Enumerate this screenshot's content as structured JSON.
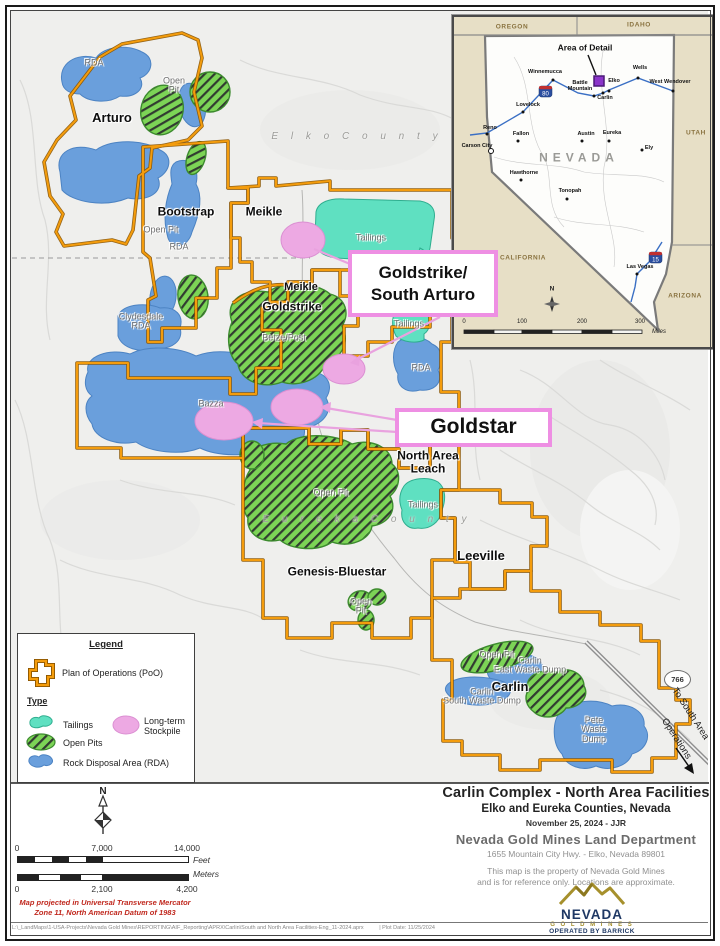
{
  "colors": {
    "poo_orange": "#f49c0c",
    "rda_blue": "#6a9fdc",
    "pit_green": "#7cd456",
    "tailings_teal": "#5fe0c1",
    "stockpile_pink": "#eda9e3",
    "callout_border": "#ee8fe3",
    "inset_tan": "#e7dfc6",
    "logo_navy": "#1f3864",
    "logo_gold": "#a6902c",
    "note_red": "#c0281e"
  },
  "map": {
    "labels": [
      {
        "t": "RDA",
        "x": 94,
        "y": 63,
        "c": "area"
      },
      {
        "t": "Open\nPit",
        "x": 174,
        "y": 86,
        "c": "area"
      },
      {
        "t": "Arturo",
        "x": 112,
        "y": 118,
        "c": "site",
        "s": 13
      },
      {
        "t": "E l k o   C o u n t y",
        "x": 357,
        "y": 137,
        "c": "county"
      },
      {
        "t": "Bootstrap",
        "x": 186,
        "y": 212,
        "c": "site",
        "s": 12
      },
      {
        "t": "Meikle",
        "x": 264,
        "y": 212,
        "c": "site",
        "s": 12
      },
      {
        "t": "Open Pit",
        "x": 161,
        "y": 230,
        "c": "area"
      },
      {
        "t": "RDA",
        "x": 179,
        "y": 247,
        "c": "area"
      },
      {
        "t": "Tailings",
        "x": 371,
        "y": 238,
        "c": "area"
      },
      {
        "t": "Meikle",
        "x": 301,
        "y": 288,
        "c": "site",
        "s": 11
      },
      {
        "t": "Goldstrike",
        "x": 292,
        "y": 307,
        "c": "site",
        "s": 12
      },
      {
        "t": "Clydesdale\nRDA",
        "x": 141,
        "y": 322,
        "c": "area"
      },
      {
        "t": "Betze/Post",
        "x": 284,
        "y": 338,
        "c": "area"
      },
      {
        "t": "Tailings",
        "x": 409,
        "y": 324,
        "c": "area"
      },
      {
        "t": "RDA",
        "x": 421,
        "y": 368,
        "c": "area"
      },
      {
        "t": "Bazza",
        "x": 211,
        "y": 404,
        "c": "area"
      },
      {
        "t": "North Area\nLeach",
        "x": 428,
        "y": 462,
        "c": "site",
        "s": 12
      },
      {
        "t": "Open Pit",
        "x": 331,
        "y": 493,
        "c": "area"
      },
      {
        "t": "Tailings",
        "x": 423,
        "y": 505,
        "c": "area"
      },
      {
        "t": "E u r e k a   C o u n t y",
        "x": 367,
        "y": 520,
        "c": "county"
      },
      {
        "t": "Leeville",
        "x": 481,
        "y": 556,
        "c": "site",
        "s": 13
      },
      {
        "t": "Genesis-Bluestar",
        "x": 337,
        "y": 572,
        "c": "site",
        "s": 12
      },
      {
        "t": "Open\nPit",
        "x": 361,
        "y": 607,
        "c": "area"
      },
      {
        "t": "Open Pit",
        "x": 497,
        "y": 655,
        "c": "area"
      },
      {
        "t": "Carlin\nEast Waste Dump",
        "x": 530,
        "y": 666,
        "c": "area"
      },
      {
        "t": "Carlin",
        "x": 510,
        "y": 687,
        "c": "site",
        "s": 13
      },
      {
        "t": "Carlin\nSouth Waste Dump",
        "x": 482,
        "y": 697,
        "c": "area"
      },
      {
        "t": "Pete\nWaste\nDump",
        "x": 594,
        "y": 730,
        "c": "area"
      },
      {
        "t": "To South Area",
        "x": 690,
        "y": 714,
        "c": "rot",
        "r": 57
      },
      {
        "t": "Operations",
        "x": 676,
        "y": 739,
        "c": "rot",
        "r": 57
      }
    ],
    "callouts": {
      "goldstrike": "Goldstrike/\nSouth Arturo",
      "goldstar": "Goldstar"
    },
    "shield_766": "766"
  },
  "legend": {
    "title": "Legend",
    "poo_label": "Plan of Operations (PoO)",
    "type_label": "Type",
    "items": [
      {
        "label": "Tailings"
      },
      {
        "label": "Open Pits"
      },
      {
        "label": "Rock Disposal Area (RDA)"
      },
      {
        "label": "Long-term\nStockpile"
      }
    ]
  },
  "inset": {
    "title": "Area of Detail",
    "nevada": "NEVADA",
    "states": [
      {
        "n": "OREGON",
        "x": 58,
        "y": 11
      },
      {
        "n": "IDAHO",
        "x": 185,
        "y": 9
      },
      {
        "n": "UTAH",
        "x": 242,
        "y": 117
      },
      {
        "n": "CALIFORNIA",
        "x": 69,
        "y": 242
      },
      {
        "n": "ARIZONA",
        "x": 231,
        "y": 280
      }
    ],
    "cities": [
      {
        "n": "Winnemucca",
        "lx": 91,
        "ly": 56,
        "dx": 99,
        "dy": 63
      },
      {
        "n": "Battle\nMountain",
        "lx": 126,
        "ly": 70,
        "dx": 140,
        "dy": 79
      },
      {
        "n": "Elko",
        "lx": 160,
        "ly": 65,
        "dx": 155,
        "dy": 74
      },
      {
        "n": "Wells",
        "lx": 186,
        "ly": 52,
        "dx": 184,
        "dy": 61
      },
      {
        "n": "West Wendover",
        "lx": 216,
        "ly": 66,
        "dx": 219,
        "dy": 74
      },
      {
        "n": "Carlin",
        "lx": 151,
        "ly": 82,
        "dx": 149,
        "dy": 76
      },
      {
        "n": "Lovelock",
        "lx": 74,
        "ly": 89,
        "dx": 69,
        "dy": 95
      },
      {
        "n": "Reno",
        "lx": 36,
        "ly": 112,
        "dx": 33,
        "dy": 117
      },
      {
        "n": "Fallon",
        "lx": 67,
        "ly": 118,
        "dx": 64,
        "dy": 124
      },
      {
        "n": "Austin",
        "lx": 132,
        "ly": 118,
        "dx": 128,
        "dy": 124
      },
      {
        "n": "Eureka",
        "lx": 158,
        "ly": 117,
        "dx": 155,
        "dy": 124
      },
      {
        "n": "Ely",
        "lx": 195,
        "ly": 132,
        "dx": 188,
        "dy": 133
      },
      {
        "n": "Carson City",
        "lx": 23,
        "ly": 130,
        "dx": 37,
        "dy": 134,
        "ring": 1
      },
      {
        "n": "Hawthorne",
        "lx": 70,
        "ly": 157,
        "dx": 67,
        "dy": 163
      },
      {
        "n": "Tonopah",
        "lx": 116,
        "ly": 175,
        "dx": 113,
        "dy": 182
      },
      {
        "n": "Las Vegas",
        "lx": 186,
        "ly": 251,
        "dx": 183,
        "dy": 257
      }
    ],
    "shield_i80": "80",
    "shield_i15": "15",
    "scale_ticks": [
      "0",
      "100",
      "200",
      "300"
    ],
    "scale_unit": "Miles",
    "north": "N"
  },
  "scalebar": {
    "north": "N",
    "feet_ticks": [
      "0",
      "7,000",
      "14,000"
    ],
    "feet_unit": "Feet",
    "meters_ticks": [
      "0",
      "2,100",
      "4,200"
    ],
    "meters_unit": "Meters",
    "note": "Map projected in Universal Transverse Mercator\nZone 11, North American Datum of 1983"
  },
  "title_block": {
    "line1": "Carlin Complex - North Area Facilities",
    "line2": "Elko and Eureka Counties, Nevada",
    "line3": "November 25, 2024   -   JJR",
    "line4": "Nevada Gold Mines Land Department",
    "line5": "1655 Mountain City Hwy. - Elko, Nevada 89801",
    "disclaimer": "This map is the property of Nevada Gold Mines\nand is for reference only. Locations are approximate."
  },
  "logo": {
    "name": "NEVADA",
    "sub": "G O L D   M I N E S",
    "tagline": "OPERATED BY BARRICK"
  },
  "footer": {
    "path": "L:\\_LandMaps\\1-USA-Projects\\Nevada Gold Mines\\REPORTING\\AIF_Reporting\\APRX\\Carlin\\South and North Area Facilities-Eng_11-2024.aprx",
    "plot": "|     Plot Date: 11/25/2024"
  }
}
